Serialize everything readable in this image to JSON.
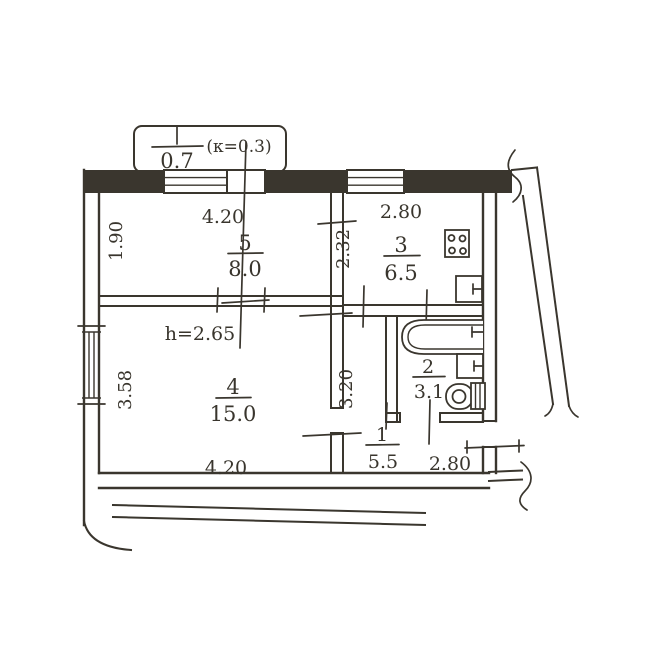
{
  "plan": {
    "title": "apartment-floor-plan",
    "balcony": {
      "value": "0.7",
      "coefficient": "(к=0.3)"
    },
    "rooms": [
      {
        "number": "5",
        "area": "8.0"
      },
      {
        "number": "3",
        "area": "6.5"
      },
      {
        "number": "4",
        "area": "15.0"
      },
      {
        "number": "2",
        "area": "3.1"
      },
      {
        "number": "1",
        "area": "5.5"
      }
    ],
    "dimensions": {
      "room5_width": "4.20",
      "room5_depth": "1.90",
      "kitchen_width": "2.80",
      "kitchen_depth": "2.32",
      "ceiling_height": "h=2.65",
      "room4_depth": "3.58",
      "room4_width": "4.20",
      "hall_depth": "3.20",
      "hall_width": "2.80"
    },
    "icons": {
      "stove": "stove-icon",
      "kitchen_sink": "sink-icon",
      "bathtub": "bathtub-icon",
      "wash_basin": "basin-icon",
      "toilet": "toilet-icon"
    },
    "colors": {
      "ink": "#3a362e",
      "paper": "#ffffff"
    }
  }
}
